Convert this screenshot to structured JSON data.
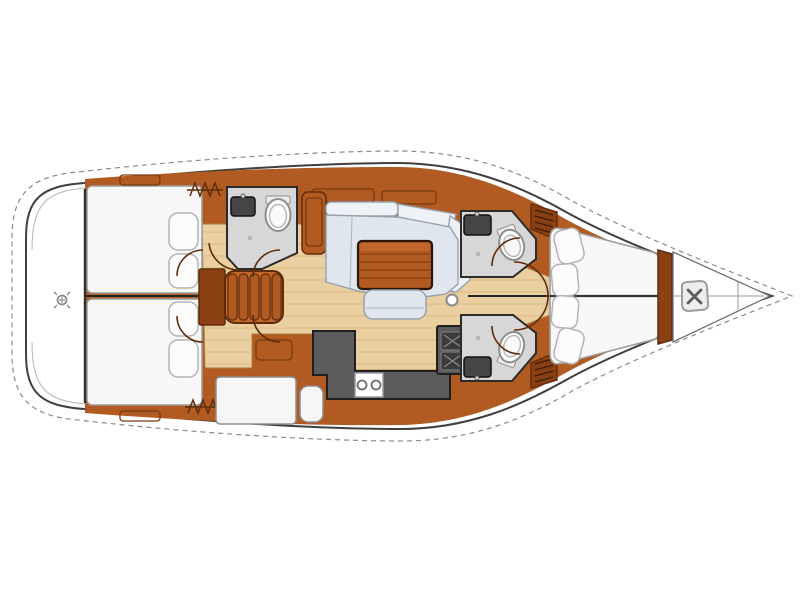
{
  "meta": {
    "title": "Sailing yacht interior layout - top-down floor plan, bow pointing right",
    "diagram_type": "boat-floor-plan",
    "visible_text": "none"
  },
  "colors": {
    "background": "#ffffff",
    "hull_fill": "#ffffff",
    "hull_stroke": "#3f3f3f",
    "deck_dash": "#8a8a8a",
    "wood": "#b15a22",
    "wood_dark": "#8a4012",
    "wood_light": "#c2672b",
    "wood_line": "#5f2c0b",
    "floor": "#ead0a0",
    "floor_stripe": "#d9ba82",
    "seat": "#dfe6ee",
    "seat_back": "#eef2f7",
    "seat_stroke": "#97a1ad",
    "counter": "#5c5c5c",
    "counter_stroke": "#1e1e1e",
    "head_floor": "#d7d7d7",
    "head_stroke": "#2b2b2b",
    "bed": "#f7f7f7",
    "bed_stroke": "#9b9b9b",
    "pillow": "#fcfcfc",
    "pillow_stroke": "#b3b3b3",
    "centerline": "#262626"
  },
  "areas": {
    "swim_platform": "stern swim platform with deck fitting",
    "aft_cabin_port": "aft double berth cabin (top) with two pillows",
    "aft_cabin_starboard": "aft double berth cabin (bottom) with two pillows",
    "aft_head": "aft head compartment with toilet and washbasin",
    "companionway_steps": "companionway steps amidships",
    "salon_settee": "L-shaped salon settee",
    "salon_table": "wooden salon table",
    "salon_bench": "salon bench seat",
    "mast_post": "mast post",
    "galley": "L-shaped galley with twin round sinks and two-burner stove",
    "forward_head_port": "forward head (top) with toilet and washbasin",
    "forward_head_starboard": "forward head (bottom) with toilet and washbasin",
    "owner_cabin": "forward owner cabin with V-berth and four pillows",
    "anchor_locker": "bow anchor locker with windlass",
    "doors": "door swing arcs at cabin and head entrances",
    "hatches": "deck hatch zigzag symbols"
  }
}
